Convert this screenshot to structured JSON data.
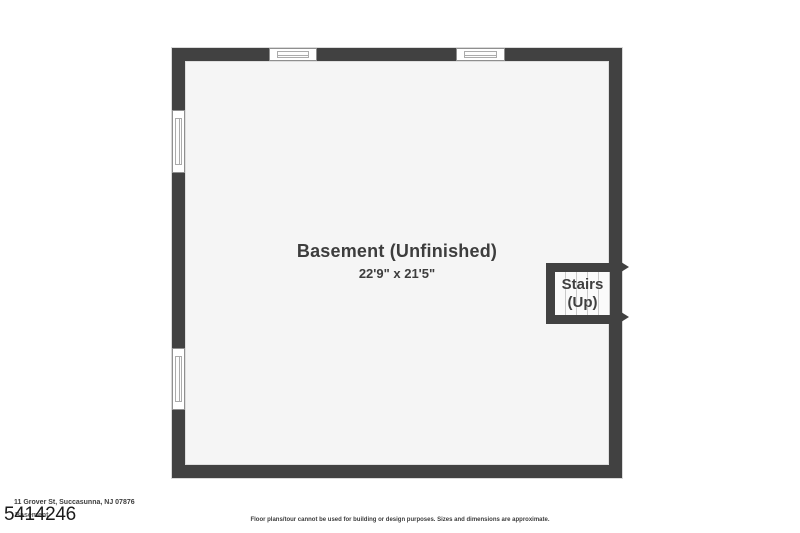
{
  "floorplan": {
    "room": {
      "label": "Basement (Unfinished)",
      "dimensions": "22'9\" x 21'5\""
    },
    "stairs": {
      "line1": "Stairs",
      "line2": "(Up)"
    },
    "window_count": 4
  },
  "footer": {
    "address": "11 Grover St, Succasunna, NJ 07876",
    "floor_name": "Basement",
    "listing_number": "5414246",
    "disclaimer": "Floor plans/tour cannot be used for building or design purposes. Sizes and dimensions are approximate."
  },
  "colors": {
    "wall": "#414141",
    "floor": "#f5f5f5",
    "text": "#3d3d3d",
    "page_background": "#ffffff"
  }
}
